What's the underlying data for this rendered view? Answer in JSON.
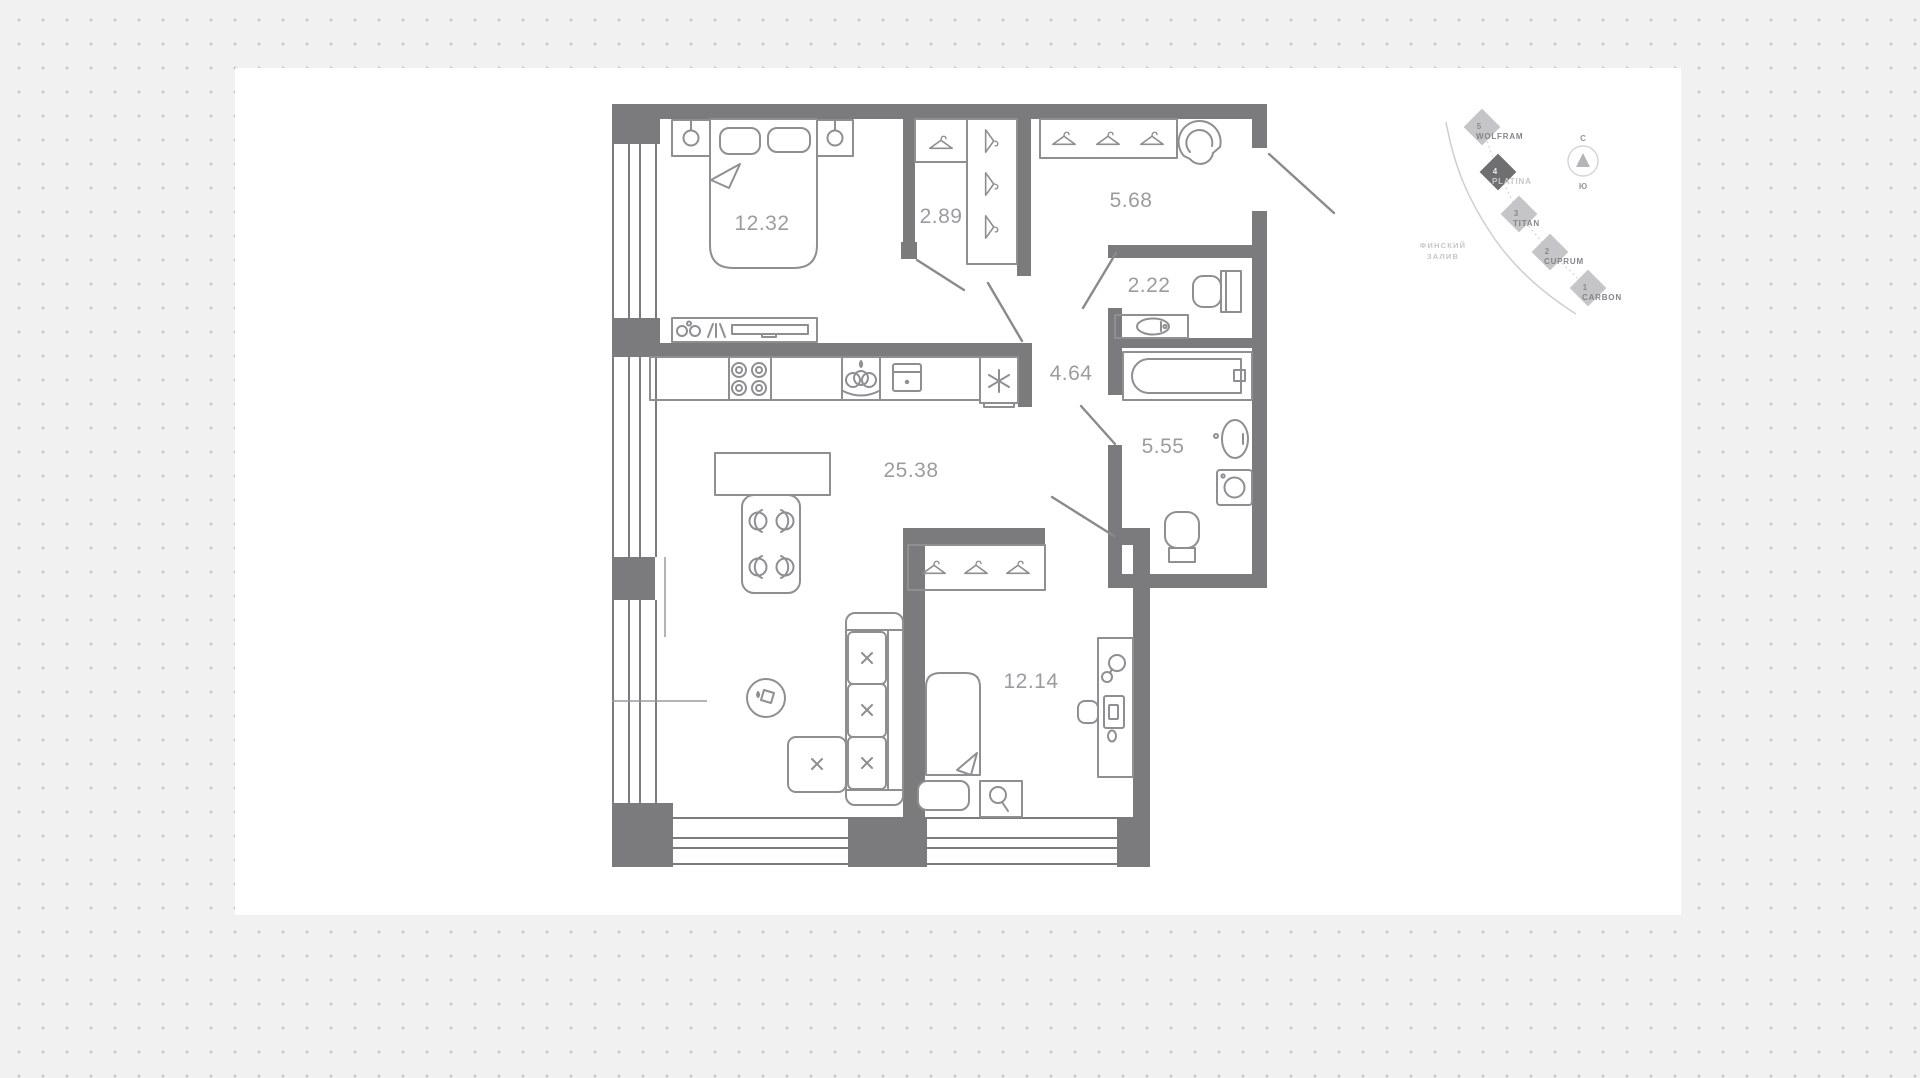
{
  "floor_plan": {
    "rooms": [
      {
        "name": "bedroom-1",
        "area": "12.32"
      },
      {
        "name": "wardrobe",
        "area": "2.89"
      },
      {
        "name": "entry-hall",
        "area": "5.68"
      },
      {
        "name": "wc",
        "area": "2.22"
      },
      {
        "name": "hall",
        "area": "4.64"
      },
      {
        "name": "bathroom",
        "area": "5.55"
      },
      {
        "name": "kitchen-living-room",
        "area": "25.38"
      },
      {
        "name": "bedroom-2",
        "area": "12.14"
      }
    ]
  },
  "site_map": {
    "buildings": [
      {
        "number": "5",
        "name": "WOLFRAM",
        "active": false
      },
      {
        "number": "4",
        "name": "PLATINA",
        "active": true
      },
      {
        "number": "3",
        "name": "TITAN",
        "active": false
      },
      {
        "number": "2",
        "name": "CUPRUM",
        "active": false
      },
      {
        "number": "1",
        "name": "CARBON",
        "active": false
      }
    ],
    "water": {
      "line1": "ФИНСКИЙ",
      "line2": "ЗАЛИВ"
    },
    "compass": {
      "north": "С",
      "south": "Ю"
    }
  },
  "colors": {
    "background": "#f1f1f2",
    "dot": "#c7c7ca",
    "panel": "#ffffff",
    "wall": "#7b7b7d",
    "furniture_line": "#8f8f91",
    "room_label": "#9c9c9e",
    "diamond": "#c5c5c7",
    "diamond_active": "#6f6f71",
    "map_text": "#85858a",
    "map_text_light": "#c6c6c8"
  }
}
